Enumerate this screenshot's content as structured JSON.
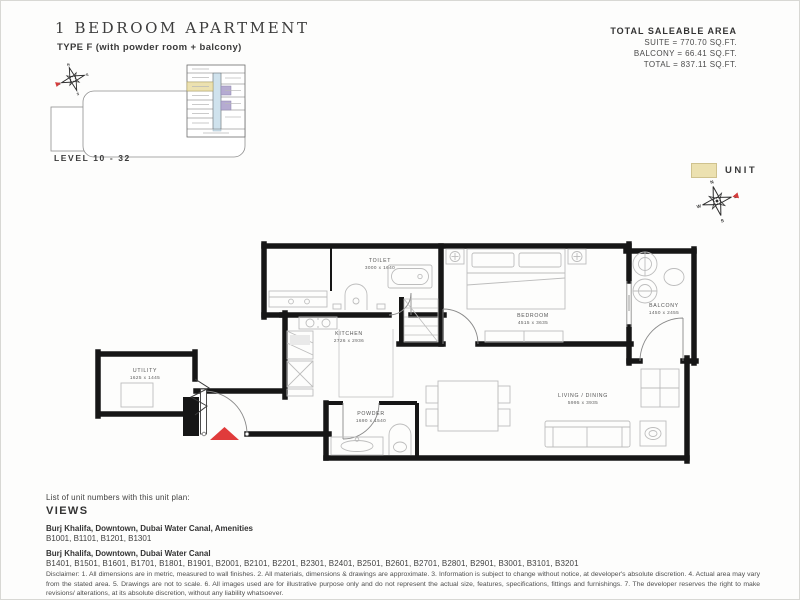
{
  "header": {
    "title": "1 BEDROOM APARTMENT",
    "subtitle": "TYPE F (with powder room + balcony)",
    "area": {
      "heading": "TOTAL SALEABLE AREA",
      "suite": "SUITE = 770.70 SQ.FT.",
      "balcony": "BALCONY = 66.41 SQ.FT.",
      "total": "TOTAL = 837.11 SQ.FT."
    }
  },
  "keyplan": {
    "level_label": "LEVEL 10 - 32",
    "highlight_color": "#ece1b0",
    "corridor_color": "#cfe2ed",
    "other_unit_color": "#b5abd1"
  },
  "legend": {
    "unit_label": "UNIT",
    "compass": {
      "n": "N",
      "e": "E",
      "s": "S",
      "w": "W"
    },
    "accent_red": "#e03b3b"
  },
  "floorplan": {
    "rooms": [
      {
        "name": "TOILET",
        "dims": "3000 x 1640"
      },
      {
        "name": "KITCHEN",
        "dims": "2726 x 2936"
      },
      {
        "name": "BEDROOM",
        "dims": "4515 x 3635"
      },
      {
        "name": "BALCONY",
        "dims": "1450 x 2455"
      },
      {
        "name": "LIVING / DINING",
        "dims": "5995 x 3935"
      },
      {
        "name": "UTILITY",
        "dims": "1625 x 1445"
      },
      {
        "name": "POWDER",
        "dims": "1690 x 1540"
      }
    ],
    "wall_color": "#161616",
    "furniture_color": "#bdbdbd"
  },
  "footer": {
    "list_intro": "List of unit numbers with this unit plan:",
    "views_heading": "VIEWS",
    "group1_title": "Burj Khalifa, Downtown, Dubai Water Canal, Amenities",
    "group1_units": "B1001, B1101, B1201, B1301",
    "group2_title": "Burj Khalifa, Downtown, Dubai Water Canal",
    "group2_units": "B1401, B1501, B1601, B1701, B1801, B1901, B2001, B2101, B2201, B2301, B2401, B2501, B2601, B2701, B2801, B2901, B3001, B3101, B3201",
    "disclaimer": "Disclaimer: 1. All dimensions are in metric, measured to wall finishes. 2. All materials, dimensions & drawings are approximate. 3. Information is subject to change without notice, at developer's absolute discretion. 4. Actual area may vary from the stated area. 5. Drawings are not to scale. 6. All images used are for illustrative purpose only and do not represent the actual size, features, specifications, fittings and furnishings. 7. The developer reserves the right to make revisions/ alterations, at its absolute discretion, without any liability whatsoever."
  }
}
